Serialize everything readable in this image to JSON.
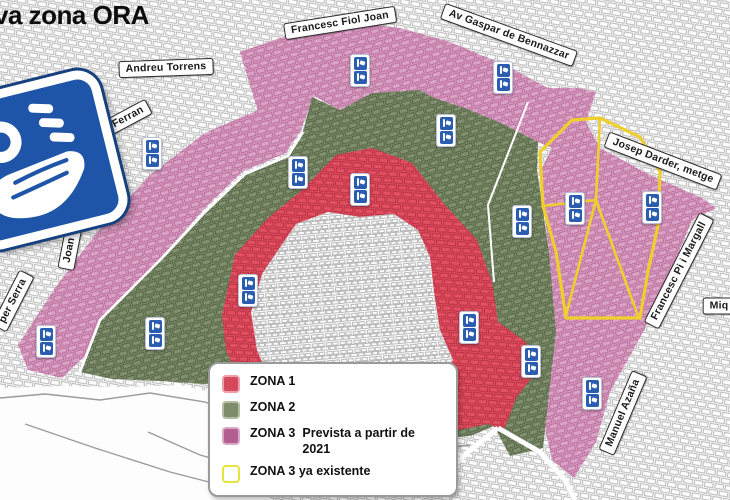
{
  "title": "va zona ORA",
  "logo": {
    "icon": "ora-parking-sign",
    "color": "#1f55a8"
  },
  "colors": {
    "zona1": "#e14f60",
    "zona2": "#80906f",
    "zona3": "#d9a3c6",
    "zona3_existing_outline": "#efcf2b",
    "marker_blue": "#2a5db0",
    "sign_blue": "#1f55a8",
    "label_border": "#2b2b2b",
    "street_gray": "#bdbdbd"
  },
  "street_labels": [
    {
      "slug": "andreu-torrens",
      "text": "Andreu Torrens",
      "x": 166,
      "y": 68,
      "rot": -2
    },
    {
      "slug": "francesc-fiol-joan",
      "text": "Francesc Fiol Joan",
      "x": 340,
      "y": 23,
      "rot": -9
    },
    {
      "slug": "av-gaspar-de-bennazzar",
      "text": "Av Gaspar de Bennazzar",
      "x": 509,
      "y": 35,
      "rot": 20
    },
    {
      "slug": "av-sant-ferran",
      "text": "Av. Sant Ferran",
      "x": 108,
      "y": 128,
      "rot": -28
    },
    {
      "slug": "joan-crespi",
      "text": "Joan Crespí",
      "x": 73,
      "y": 232,
      "rot": -79
    },
    {
      "slug": "per-serra",
      "text": "per Serra",
      "x": 13,
      "y": 301,
      "rot": -63
    },
    {
      "slug": "josep-darder-metge",
      "text": "Josep Darder, metge",
      "x": 663,
      "y": 161,
      "rot": 21
    },
    {
      "slug": "francesc-pi-i-margall",
      "text": "Francesc Pi i Margall",
      "x": 679,
      "y": 271,
      "rot": -63
    },
    {
      "slug": "manuel-azana",
      "text": "Manuel Azaña",
      "x": 623,
      "y": 413,
      "rot": -67
    },
    {
      "slug": "miq-truncated",
      "text": "Miq",
      "x": 719,
      "y": 306,
      "rot": 0
    }
  ],
  "markers": [
    {
      "x": 152,
      "y": 153
    },
    {
      "x": 360,
      "y": 70
    },
    {
      "x": 503,
      "y": 77
    },
    {
      "x": 446,
      "y": 130
    },
    {
      "x": 298,
      "y": 172
    },
    {
      "x": 360,
      "y": 189
    },
    {
      "x": 522,
      "y": 221
    },
    {
      "x": 575,
      "y": 208
    },
    {
      "x": 652,
      "y": 207
    },
    {
      "x": 248,
      "y": 290
    },
    {
      "x": 155,
      "y": 333
    },
    {
      "x": 46,
      "y": 341
    },
    {
      "x": 469,
      "y": 327
    },
    {
      "x": 531,
      "y": 361
    },
    {
      "x": 592,
      "y": 393
    }
  ],
  "legend": {
    "items": [
      {
        "label": "ZONA 1",
        "desc": "",
        "swatch": "#d5495c",
        "swatch_border": "#eda0ab"
      },
      {
        "label": "ZONA 2",
        "desc": "",
        "swatch": "#7d8d6c",
        "swatch_border": "#b3bda2"
      },
      {
        "label": "ZONA 3",
        "desc": "Prevista a partir de 2021",
        "swatch": "#b25e90",
        "swatch_border": "#d9a8c6"
      },
      {
        "label": "ZONA 3 ya existente",
        "desc": "",
        "swatch": "#ffffff",
        "swatch_border": "#e6e43e"
      }
    ]
  }
}
